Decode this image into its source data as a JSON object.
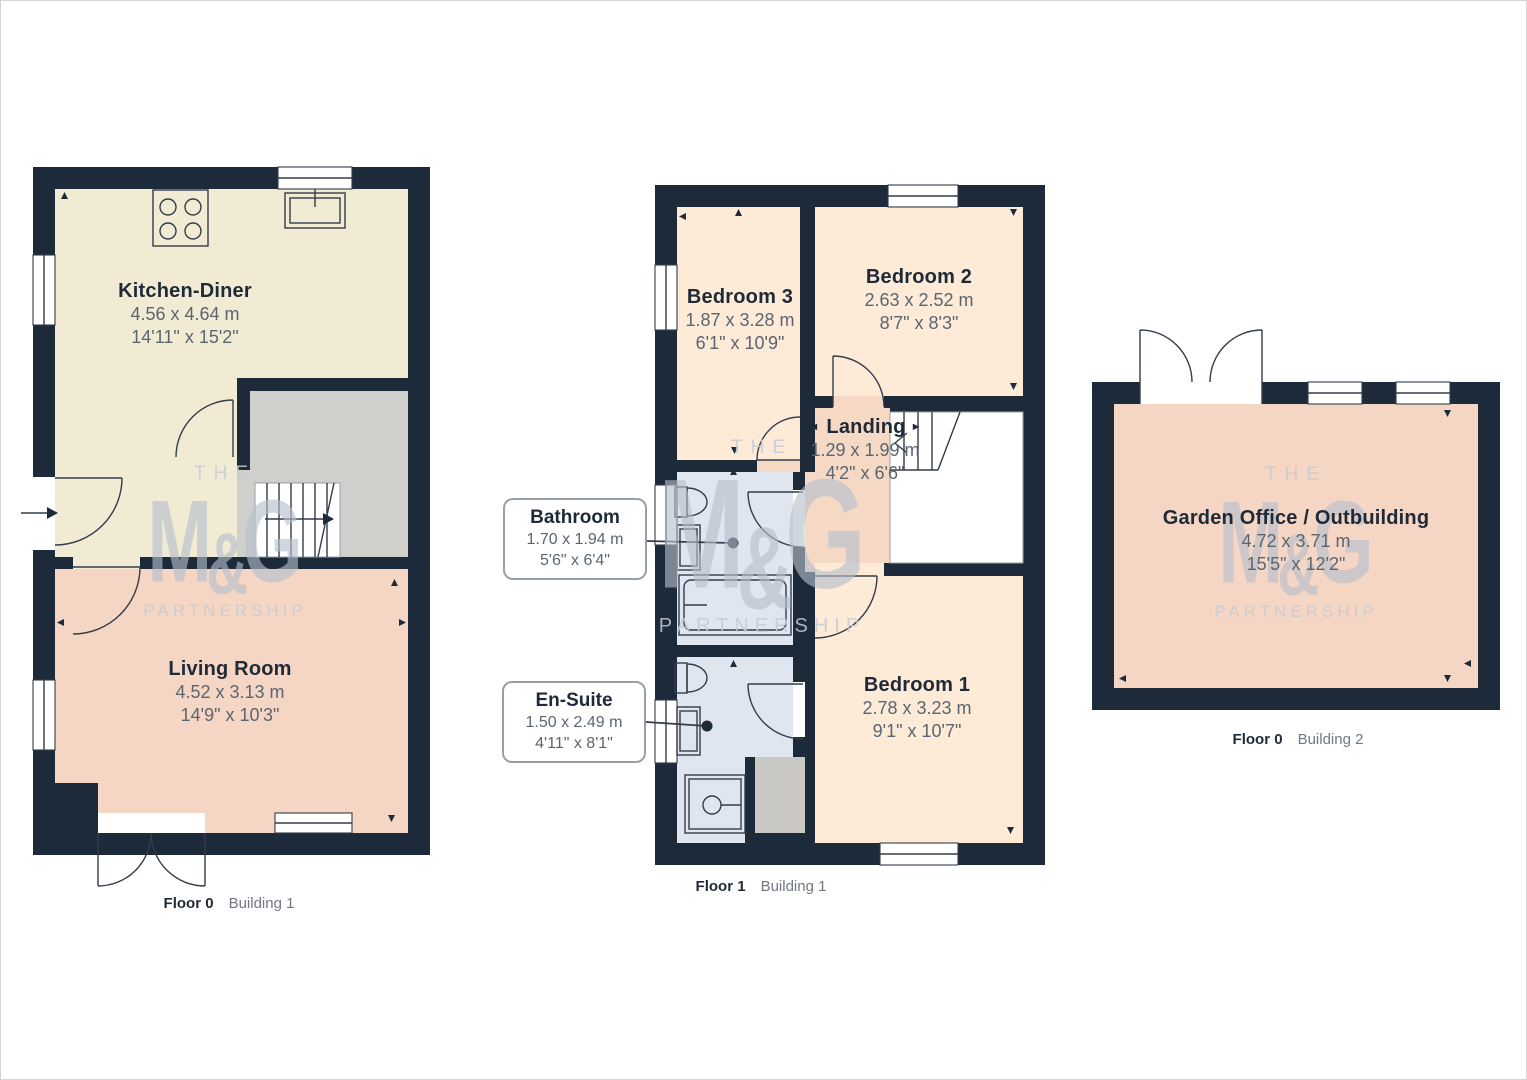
{
  "colors": {
    "wall": "#1c2a39",
    "line": "#333c49",
    "kitchen": "#f1ebd4",
    "living": "#f5d5c3",
    "bedroom": "#fdead7",
    "landing": "#f5d9c5",
    "bathroom": "#e0e6ef",
    "stairs": "#cfcfcc",
    "cupboard": "#c9c8c4",
    "label_dark": "#1f2a38",
    "dim_gray": "#5b6571",
    "caption_gray": "#6f7884",
    "watermark": "#b6bfcd"
  },
  "watermark": {
    "the": "THE",
    "m": "M",
    "amp": "&",
    "g": "G",
    "partnership": "PARTNERSHIP"
  },
  "plans": [
    {
      "floor": "Floor 0",
      "building": "Building 1",
      "rooms": [
        {
          "name": "Kitchen-Diner",
          "metric": "4.56 x 4.64 m",
          "imperial": "14'11\" x 15'2\""
        },
        {
          "name": "Living Room",
          "metric": "4.52 x 3.13 m",
          "imperial": "14'9\" x 10'3\""
        }
      ]
    },
    {
      "floor": "Floor 1",
      "building": "Building 1",
      "rooms": [
        {
          "name": "Bedroom 3",
          "metric": "1.87 x 3.28 m",
          "imperial": "6'1\" x 10'9\""
        },
        {
          "name": "Bedroom 2",
          "metric": "2.63 x 2.52 m",
          "imperial": "8'7\" x 8'3\""
        },
        {
          "name": "Landing",
          "metric": "1.29 x 1.99 m",
          "imperial": "4'2\" x 6'6\""
        },
        {
          "name": "Bedroom 1",
          "metric": "2.78 x 3.23 m",
          "imperial": "9'1\" x 10'7\""
        }
      ],
      "callouts": [
        {
          "name": "Bathroom",
          "metric": "1.70 x 1.94 m",
          "imperial": "5'6\" x 6'4\""
        },
        {
          "name": "En-Suite",
          "metric": "1.50 x 2.49 m",
          "imperial": "4'11\" x 8'1\""
        }
      ]
    },
    {
      "floor": "Floor 0",
      "building": "Building 2",
      "rooms": [
        {
          "name": "Garden Office / Outbuilding",
          "metric": "4.72 x 3.71 m",
          "imperial": "15'5\" x 12'2\""
        }
      ]
    }
  ]
}
